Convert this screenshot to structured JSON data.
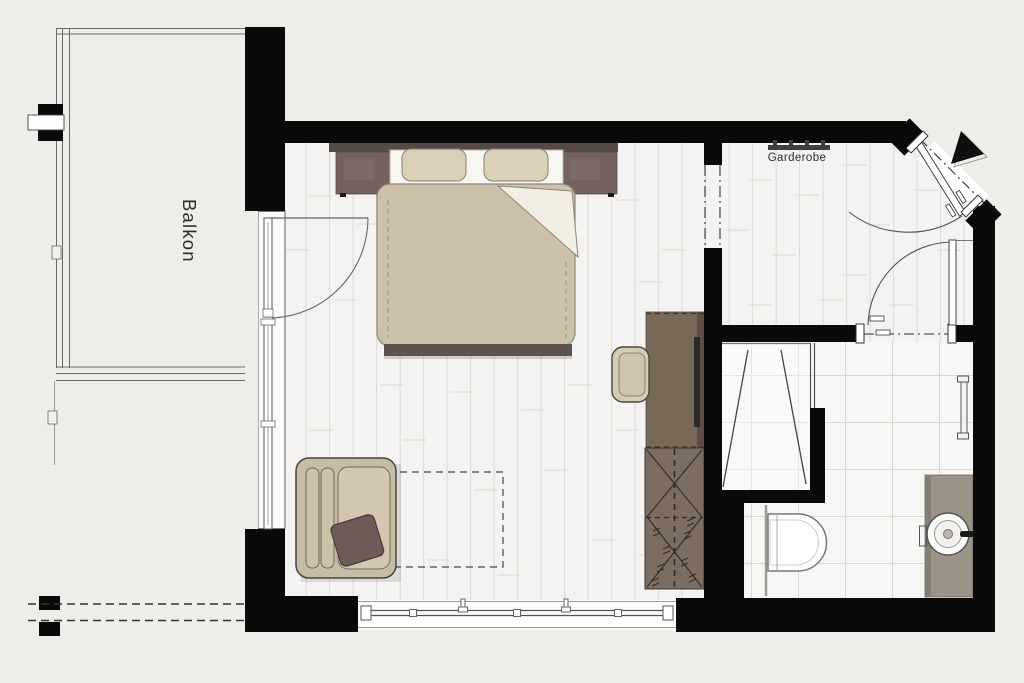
{
  "labels": {
    "balcony": "Balkon",
    "coat_rack": "Garderobe"
  },
  "colors": {
    "background": "#edede9",
    "wall": "#0a0a0a",
    "plank_floor": "#f4f3f1",
    "plank_line": "#dcdcd8",
    "tile_floor": "#f6f6f4",
    "tile_line": "#d8d8d4",
    "bed_duvet_beige": "#cdc1a9",
    "pillow_beige": "#dbcfb8",
    "headboard_dark_brown": "#564a47",
    "nightstand_brown": "#75625f",
    "desk_brown": "#786858",
    "wardrobe_brown": "#7d6d60",
    "armchair_beige": "#c8bca4",
    "dark_cushion": "#6d5a59",
    "vanity_taupe": "#9a9386",
    "line_dark": "#444444"
  },
  "fixtures": {
    "bedroom": [
      "double-bed",
      "nightstand-left",
      "nightstand-right",
      "armchair",
      "dark-cushion",
      "dashed-table-outline",
      "desk-sideboard",
      "tv",
      "desk-chair",
      "wardrobe-closet",
      "balcony-door",
      "window-front"
    ],
    "entrance_hall": [
      "coat-rack",
      "entrance-door",
      "passage-marker"
    ],
    "bathroom": [
      "shower",
      "toilet",
      "washbasin-vanity",
      "towel-rail",
      "bathroom-door"
    ],
    "balcony": [
      "railing",
      "wall-anchor",
      "roof-edge-dashed"
    ]
  }
}
